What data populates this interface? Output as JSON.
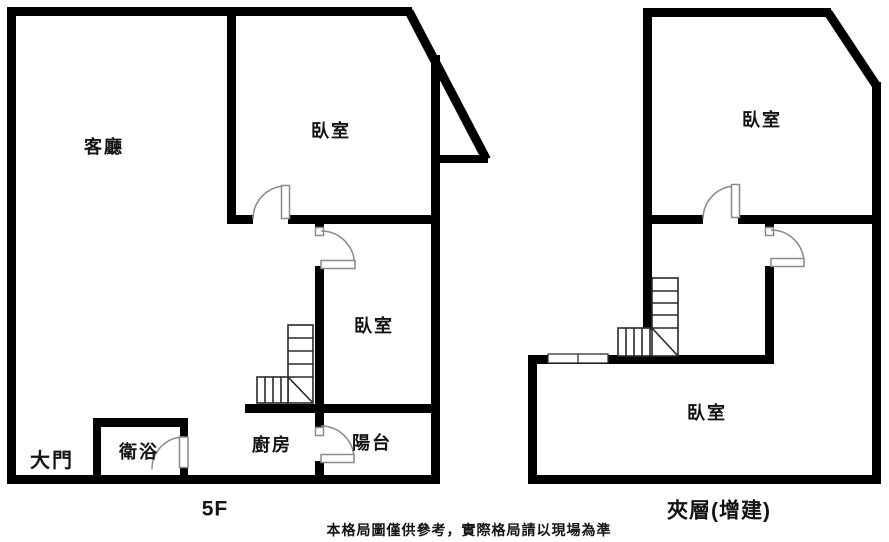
{
  "floorplan": {
    "left_unit": {
      "floor_label": "5F",
      "rooms": {
        "living_room": "客廳",
        "bedroom_top": "臥室",
        "bedroom_mid": "臥室",
        "bathroom": "衛浴",
        "kitchen": "廚房",
        "balcony": "陽台",
        "main_entrance": "大門"
      }
    },
    "right_unit": {
      "floor_label": "夾層(增建)",
      "rooms": {
        "bedroom_top": "臥室",
        "bedroom_bottom": "臥室"
      }
    },
    "disclaimer": "本格局圖僅供參考，實際格局請以現場為準",
    "colors": {
      "wall": "#000000",
      "background": "#ffffff",
      "door_symbol": "#8a8a8a",
      "stair_line": "#2a2a2a",
      "text": "#141414"
    }
  }
}
